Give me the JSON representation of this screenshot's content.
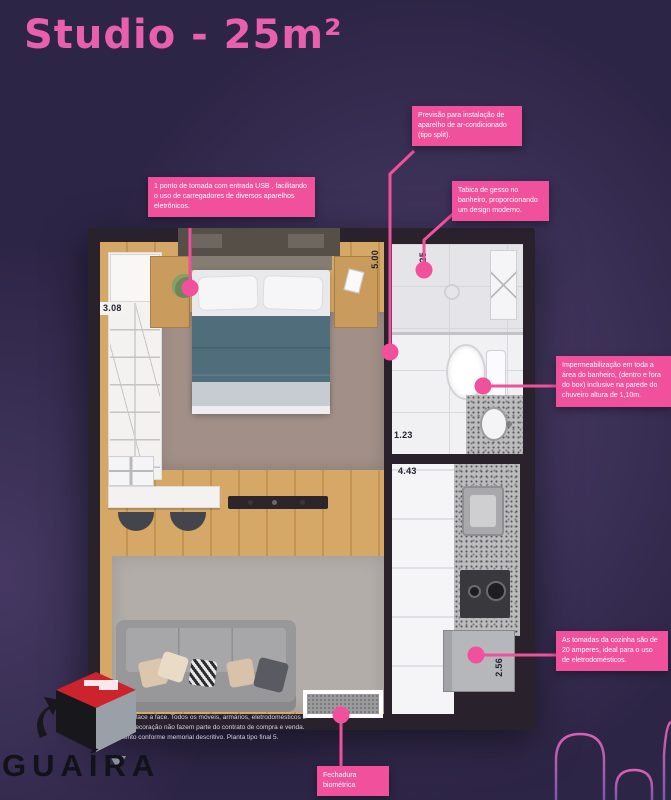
{
  "title": "Studio - 25m²",
  "theme": {
    "background": "#2d2546",
    "accent_pink": "#f0509c",
    "title_pink": "#e75fad",
    "wall_color": "#29222c",
    "logo_red": "#cc232c"
  },
  "callouts": {
    "usb": "1 ponto de tomada com entrada USB , facilitando o uso de carregadores de diversos aparelhos eletrônicos.",
    "ac": "Previsão para instalação de aparelho de ar-condicionado (tipo split).",
    "gesso": "Tabica de gesso no banheiro, proporcionando um design moderno.",
    "waterproof": "Impermeabilização em toda a área do banheiro, (dentro e fora do box) inclusive na parede do chuveiro altura de 1,10m.",
    "outlets": "As tomadas da cozinha são de 20 amperes, ideal para o uso de eletrodomésticos.",
    "lock": "Fechadura biométrica"
  },
  "dims": {
    "closet": "3.08",
    "bedroom": "5.00",
    "bath": "2.25",
    "bath_b": "1.23",
    "kitchen": "4.43",
    "fridge": "2.56"
  },
  "footer": {
    "brand": "GUAÍRA",
    "disclaimer": "Medidas de face a face. Todos os móveis, armários, eletrodomésticos e objetos de decoração não fazem parte do contrato de compra e venda. Acabamento conforme memorial descritivo. Planta tipo final 5."
  }
}
